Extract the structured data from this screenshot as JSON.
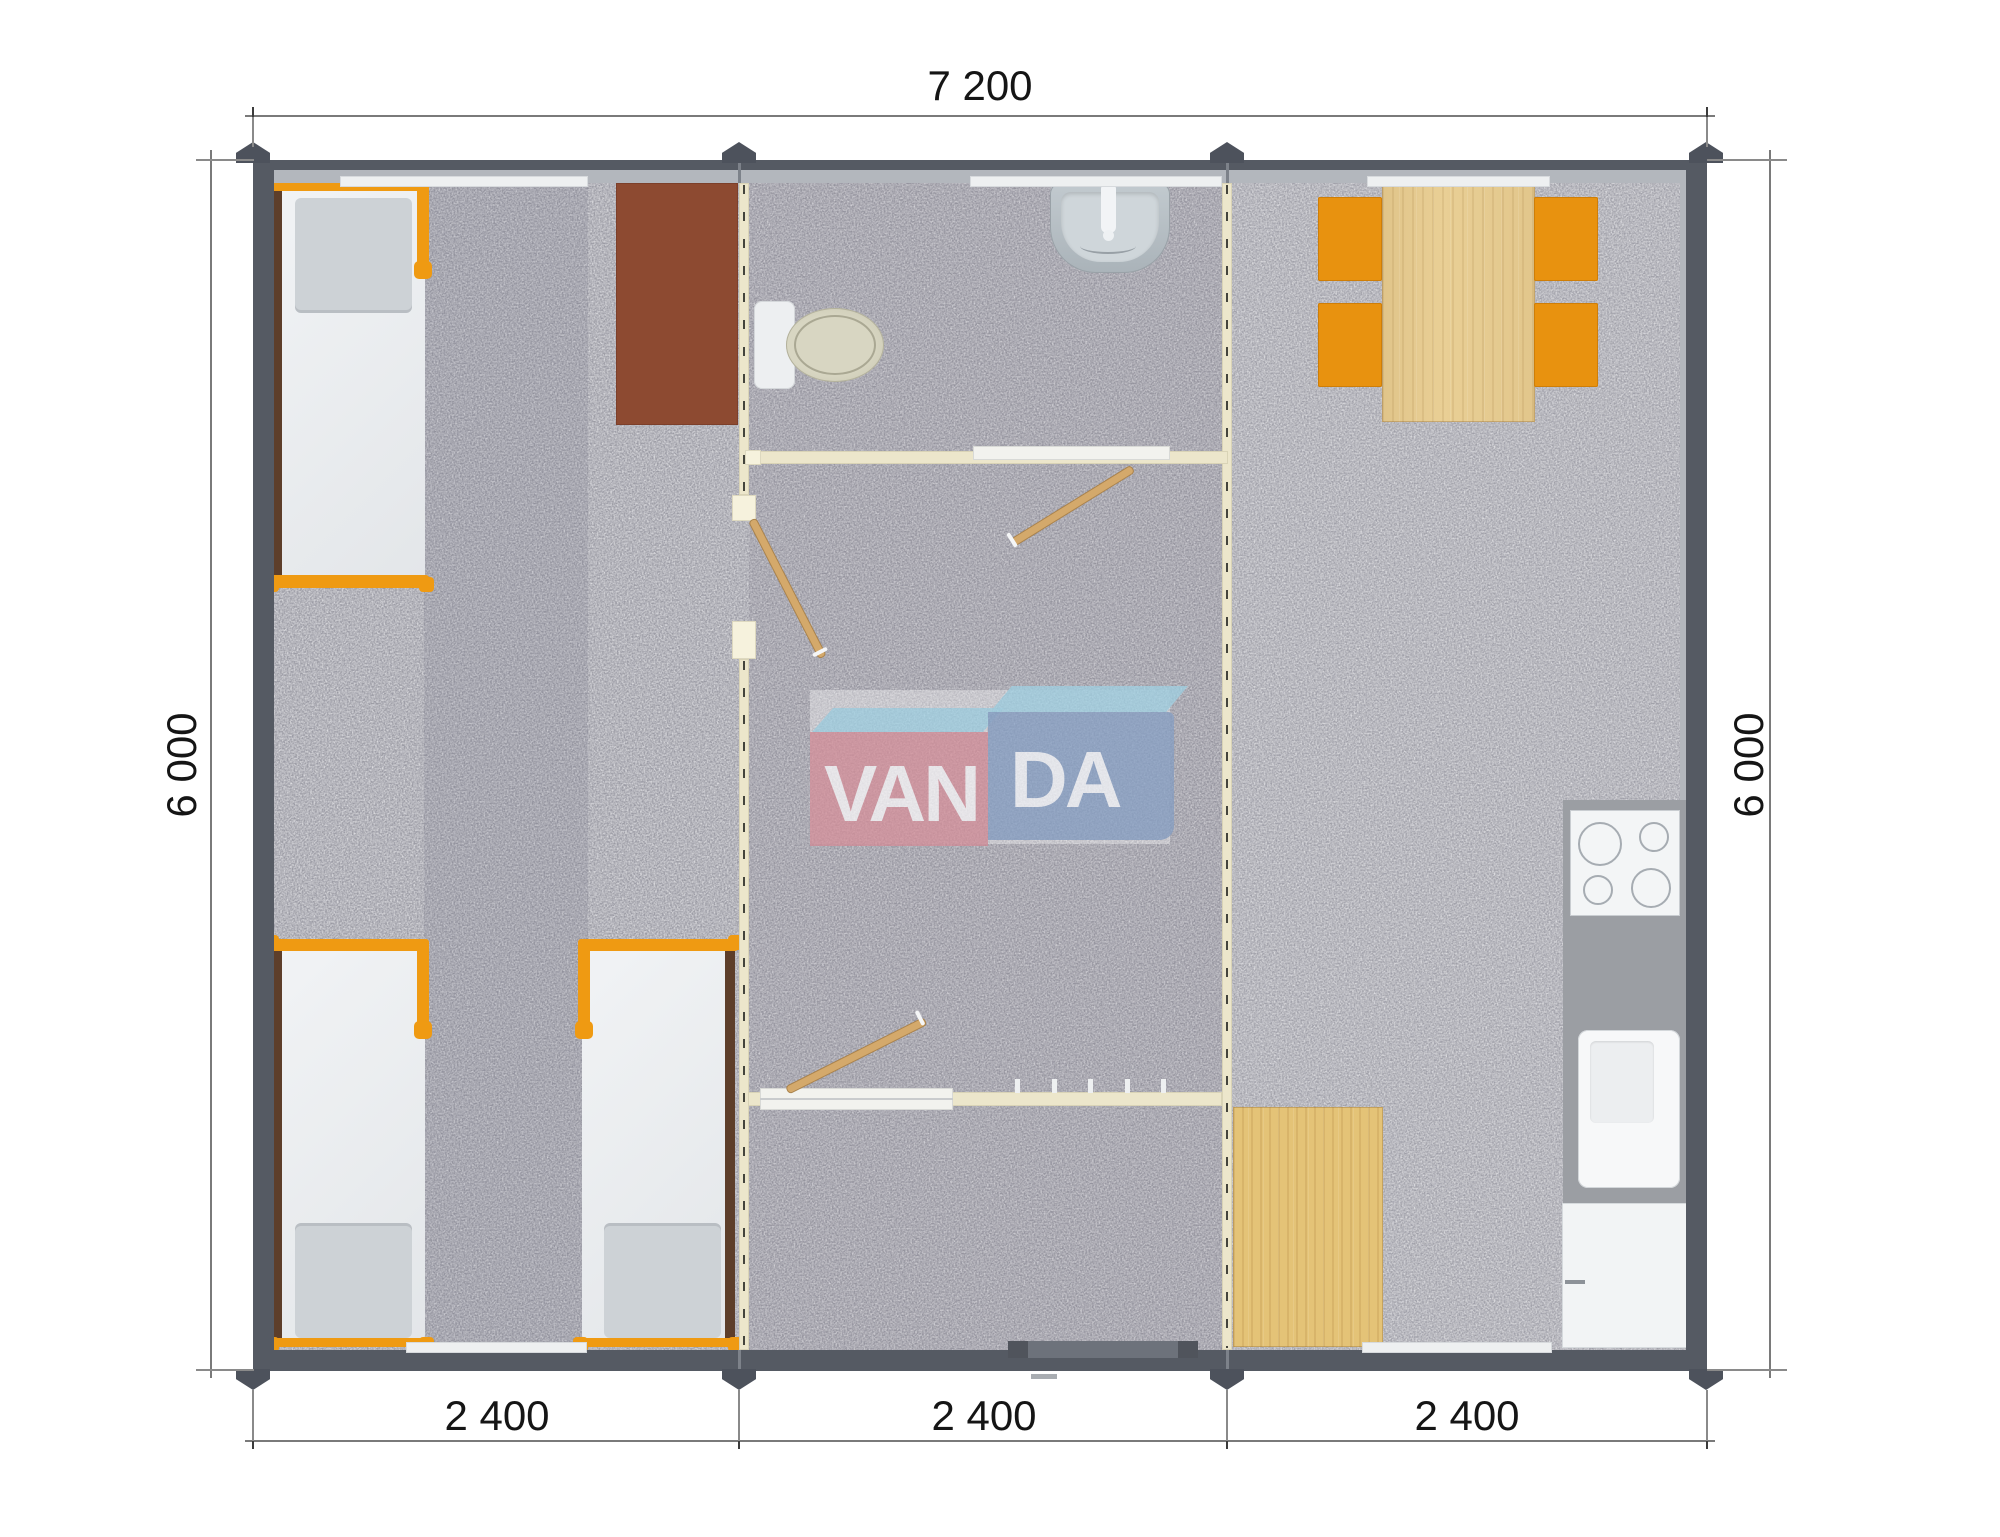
{
  "drawing": {
    "type": "floor-plan",
    "dimensions": {
      "top_width": "7 200",
      "left_height": "6 000",
      "right_height": "6 000",
      "bottom_modules": [
        "2 400",
        "2 400",
        "2 400"
      ]
    },
    "watermark": {
      "left_text": "VAN",
      "right_text": "DA"
    },
    "colors": {
      "wall": "#555a63",
      "wall_lining": "#b3b7bd",
      "partition_cream": "#ece6cb",
      "floor_gray": "#9b9ba3",
      "accent_orange": "#ef9a12",
      "desk_brown": "#8d4a31",
      "wood_light": "#e9cf95",
      "logo_pink": "#d58893",
      "logo_blue": "#829cc3",
      "logo_top_blue": "#9ed3e5",
      "dimension_text": "#151515"
    }
  }
}
